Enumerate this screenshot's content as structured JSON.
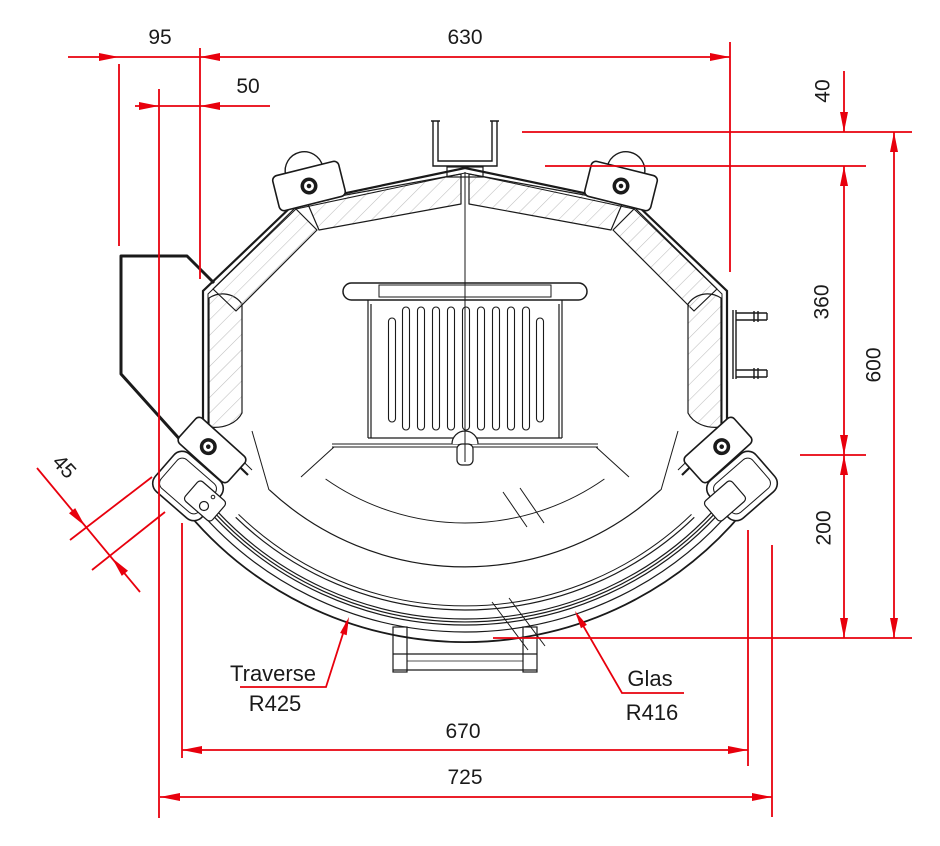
{
  "drawing": {
    "type": "technical-cross-section",
    "dimensions": {
      "d95": "95",
      "d50": "50",
      "d630": "630",
      "d40": "40",
      "d360": "360",
      "d600": "600",
      "d200": "200",
      "d45": "45",
      "d670": "670",
      "d725": "725"
    },
    "labels": {
      "traverse_name": "Traverse",
      "traverse_radius": "R425",
      "glas_name": "Glas",
      "glas_radius": "R416"
    },
    "colors": {
      "dimension_red": "#e8000d",
      "line_black": "#1a1a1a",
      "hatch_gray": "#bdbdbd",
      "background": "#ffffff"
    }
  }
}
